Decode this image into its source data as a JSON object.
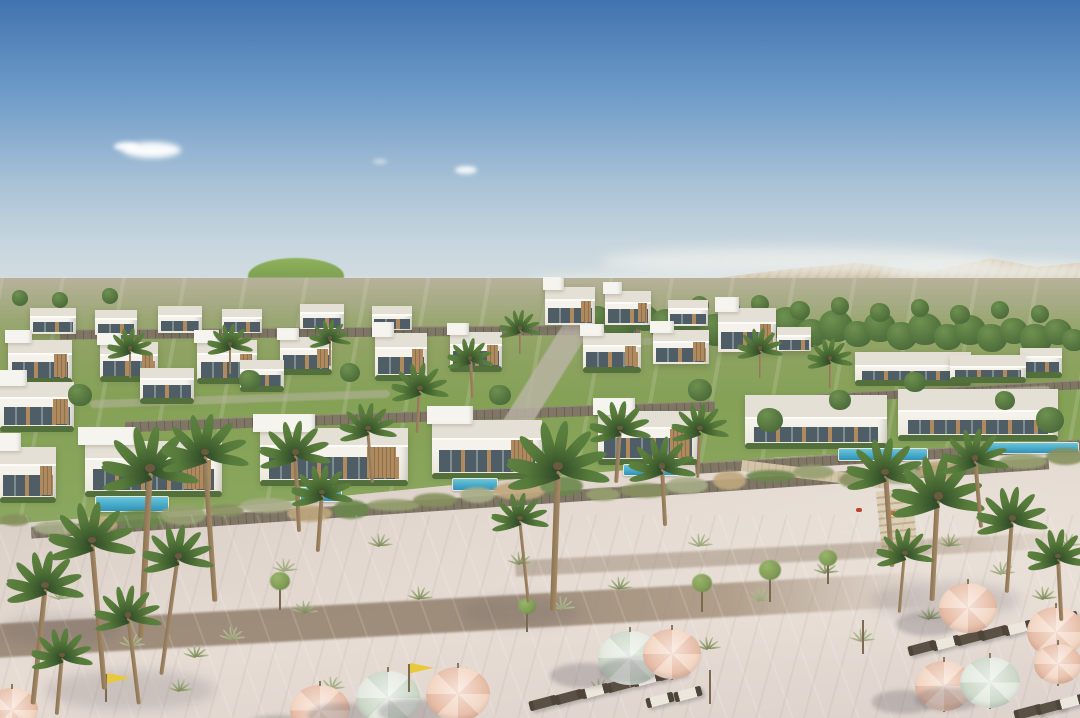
{
  "meta": {
    "subject": "Aerial rendering of a beachfront villa resort with desert mountains, terraced white villas, palm trees and a sandy beach with umbrellas",
    "caption": ""
  },
  "palette": {
    "sky_top": "#4173ae",
    "sky_mid": "#6f9cc9",
    "sky_low": "#a9c2d6",
    "sky_horizon": "#dde3e1",
    "cloud": "#ffffff",
    "mountain_light": "#dbc9aa",
    "mountain": "#c8b191",
    "mountain_dark": "#b29a78",
    "hill": "#6f9147",
    "hill_light": "#8fb25c",
    "far_lawn": "#87a355",
    "far_strip": "#dcdad0",
    "tree_dark": "#42603a",
    "tree": "#55763f",
    "tree_light": "#6e9150",
    "sapling": "#7f9b55",
    "terrace_a": "#b7b29b",
    "terrace_b": "#93a468",
    "terrace_c": "#84a156",
    "villa": "#f4f2ea",
    "villa_shade": "#e0dcd0",
    "roof": "#e4e0d5",
    "fascia": "#fcfbf8",
    "glass": "#4e5d66",
    "glass_light": "#7e8d8d",
    "wood": "#b08a5f",
    "wood_dark": "#8f6f4c",
    "stone": "#7f7666",
    "stone_dark": "#6b6253",
    "stone_light": "#958c7b",
    "hedge": "#53703c",
    "road": "#bcb5a7",
    "pool_light": "#6ac7da",
    "pool_deep": "#2e92ba",
    "pool_deck": "#ece5d6",
    "sand_dark": "#cec2b9",
    "sand": "#ded3cb",
    "sand_light": "#e6dcd4",
    "path": "#8d7a65",
    "dune_colors": [
      "#87915f",
      "#a7ad87",
      "#c0a87e",
      "#6b874c",
      "#97a171"
    ],
    "grass_olive": "#7b8a57",
    "grass_sage": "#9aa578",
    "palm_dark": "#2f4a28",
    "palm_light": "#5d8140",
    "trunk_dark": "#8a7354",
    "trunk_light": "#a68b67",
    "umbrella_peach": "#f3d6c4",
    "umbrella_peach_dark": "#e7bda7",
    "umbrella_mint": "#e4eae0",
    "umbrella_mint_dark": "#ccd8c8",
    "lounger_dark": "#4e4438",
    "lounger_mid": "#5a5144",
    "cushion": "#ece7dd",
    "flag_yellow": "#e9c93c",
    "pole": "#7d6a52",
    "shadow": "rgba(95,88,98,0.28)"
  },
  "sky": {
    "height": 318
  },
  "clouds": [
    [
      152,
      150,
      58,
      16,
      0.95,
      3
    ],
    [
      126,
      146,
      24,
      9,
      0.9,
      2
    ],
    [
      466,
      170,
      22,
      8,
      0.85,
      2
    ],
    [
      380,
      161,
      14,
      5,
      0.5,
      2
    ]
  ],
  "haze": [
    [
      800,
      262,
      400,
      28,
      0.75,
      6
    ],
    [
      1000,
      272,
      240,
      24,
      0.8,
      6
    ],
    [
      640,
      282,
      220,
      18,
      0.55,
      6
    ],
    [
      180,
      298,
      400,
      20,
      0.45,
      5
    ],
    [
      430,
      296,
      280,
      16,
      0.4,
      5
    ],
    [
      540,
      300,
      1080,
      36,
      0.42,
      5
    ]
  ],
  "mountain": {
    "left": 552,
    "top": 246,
    "width": 528,
    "height": 104,
    "clip": "polygon(0 82%,10.5% 55%,20% 41%,31% 31%,45% 22%,58% 16%,71% 25%,83% 12%,92% 20%,100% 16%,100% 100%,0 100%)"
  },
  "hill": [
    248,
    258,
    96,
    36
  ],
  "far_lawn": [
    0,
    294,
    108,
    46
  ],
  "far_strip": [
    0,
    278,
    672,
    42
  ],
  "far_boxes": [
    [
      5,
      291
    ],
    [
      25,
      286
    ],
    [
      48,
      292
    ],
    [
      70,
      288
    ],
    [
      95,
      284
    ],
    [
      118,
      291
    ],
    [
      140,
      287
    ],
    [
      165,
      293
    ],
    [
      185,
      286
    ],
    [
      210,
      290
    ],
    [
      235,
      284
    ],
    [
      258,
      292
    ],
    [
      282,
      287
    ],
    [
      305,
      283
    ],
    [
      330,
      290
    ],
    [
      352,
      285
    ],
    [
      375,
      291
    ],
    [
      398,
      286
    ],
    [
      420,
      292
    ],
    [
      445,
      287
    ],
    [
      468,
      283
    ],
    [
      490,
      290
    ],
    [
      512,
      285
    ],
    [
      535,
      291
    ],
    [
      558,
      287
    ],
    [
      580,
      292
    ],
    [
      602,
      288
    ],
    [
      625,
      284
    ],
    [
      645,
      291
    ],
    [
      688,
      295
    ],
    [
      714,
      291
    ],
    [
      738,
      296
    ]
  ],
  "terrace": {
    "left": 0,
    "top": 278,
    "width": 1080,
    "height": 268,
    "clip": "polygon(0 0,100% 0,100% 61%,72% 67%,45% 76%,20% 86%,0 92%)"
  },
  "walls": [
    [
      540,
      497,
      1020,
      11,
      -3.9
    ],
    [
      420,
      416,
      590,
      10,
      -2
    ],
    [
      890,
      456,
      390,
      10,
      -3.5
    ],
    [
      350,
      331,
      580,
      9,
      -0.5
    ],
    [
      950,
      391,
      270,
      8,
      -3
    ]
  ],
  "roads": [
    [
      545,
      378,
      26,
      140,
      32,
      0.8
    ],
    [
      240,
      399,
      300,
      8,
      -2,
      0.5
    ],
    [
      1005,
      392,
      90,
      9,
      -3,
      0.7
    ],
    [
      700,
      340,
      200,
      7,
      -1,
      0.4
    ]
  ],
  "trees_back": [
    [
      598,
      318,
      13
    ],
    [
      620,
      324,
      16
    ],
    [
      645,
      318,
      14
    ],
    [
      668,
      326,
      18
    ],
    [
      694,
      320,
      15
    ],
    [
      716,
      330,
      17
    ],
    [
      740,
      322,
      14
    ],
    [
      762,
      331,
      16
    ],
    [
      788,
      324,
      18
    ],
    [
      812,
      333,
      15
    ],
    [
      836,
      326,
      17
    ],
    [
      858,
      334,
      14
    ],
    [
      880,
      327,
      16
    ],
    [
      902,
      336,
      15
    ],
    [
      925,
      329,
      17
    ],
    [
      948,
      337,
      14
    ],
    [
      970,
      330,
      16
    ],
    [
      992,
      338,
      15
    ],
    [
      1014,
      331,
      14
    ],
    [
      1036,
      339,
      16
    ],
    [
      1058,
      332,
      14
    ],
    [
      1074,
      340,
      12
    ],
    [
      700,
      305,
      9
    ],
    [
      730,
      308,
      10
    ],
    [
      760,
      304,
      9
    ],
    [
      800,
      310,
      10
    ],
    [
      840,
      306,
      9
    ],
    [
      880,
      312,
      10
    ],
    [
      920,
      308,
      9
    ],
    [
      960,
      314,
      10
    ],
    [
      1000,
      310,
      9
    ],
    [
      1040,
      314,
      9
    ],
    [
      20,
      298,
      8
    ],
    [
      60,
      300,
      8
    ],
    [
      110,
      296,
      8
    ]
  ],
  "trees_front": [
    [
      80,
      395,
      12
    ],
    [
      250,
      380,
      11
    ],
    [
      350,
      372,
      10
    ],
    [
      500,
      395,
      11
    ],
    [
      700,
      390,
      12
    ],
    [
      770,
      420,
      13
    ],
    [
      840,
      400,
      11
    ],
    [
      1050,
      420,
      14
    ],
    [
      915,
      382,
      11
    ],
    [
      1005,
      400,
      10
    ]
  ],
  "saplings": [
    [
      280,
      588,
      10
    ],
    [
      527,
      612,
      9
    ],
    [
      702,
      590,
      10
    ],
    [
      770,
      578,
      11
    ],
    [
      828,
      564,
      9
    ]
  ],
  "villas": [
    [
      30,
      308,
      46,
      26,
      0
    ],
    [
      95,
      310,
      42,
      25,
      0
    ],
    [
      158,
      306,
      44,
      27,
      0
    ],
    [
      222,
      309,
      40,
      24,
      0
    ],
    [
      300,
      304,
      44,
      25,
      0
    ],
    [
      372,
      306,
      40,
      24,
      0
    ],
    [
      545,
      287,
      50,
      38,
      1
    ],
    [
      605,
      291,
      46,
      34,
      1
    ],
    [
      668,
      300,
      40,
      26,
      0
    ],
    [
      8,
      340,
      64,
      40,
      1
    ],
    [
      100,
      342,
      58,
      36,
      1
    ],
    [
      197,
      340,
      60,
      40,
      1
    ],
    [
      280,
      337,
      52,
      34,
      1
    ],
    [
      375,
      333,
      52,
      44,
      1
    ],
    [
      450,
      332,
      52,
      36,
      1
    ],
    [
      583,
      333,
      58,
      36,
      1
    ],
    [
      653,
      330,
      56,
      34,
      1
    ],
    [
      718,
      308,
      58,
      44,
      1
    ],
    [
      777,
      327,
      34,
      24,
      0
    ],
    [
      855,
      352,
      116,
      30,
      2
    ],
    [
      950,
      355,
      76,
      24,
      2
    ],
    [
      1020,
      348,
      42,
      26,
      0
    ],
    [
      0,
      382,
      74,
      46,
      1
    ],
    [
      140,
      368,
      54,
      32,
      0
    ],
    [
      240,
      360,
      44,
      28,
      0
    ],
    [
      0,
      447,
      56,
      52,
      1
    ],
    [
      85,
      441,
      137,
      52,
      1
    ],
    [
      260,
      428,
      148,
      54,
      1
    ],
    [
      432,
      420,
      110,
      55,
      1
    ],
    [
      598,
      411,
      100,
      50,
      1
    ],
    [
      745,
      395,
      142,
      50,
      2
    ],
    [
      898,
      389,
      160,
      48,
      2
    ]
  ],
  "pools": [
    [
      95,
      496,
      72,
      14
    ],
    [
      300,
      487,
      40,
      13
    ],
    [
      452,
      478,
      44,
      11
    ],
    [
      623,
      464,
      54,
      10
    ],
    [
      838,
      448,
      88,
      11
    ],
    [
      985,
      442,
      92,
      10
    ]
  ],
  "boardwalk": {
    "walk": [
      815,
      474,
      148,
      11,
      7
    ],
    "stairs": [
      897,
      522,
      36,
      64,
      -6
    ]
  },
  "paths": [
    [
      440,
      616,
      980,
      34,
      -3.2,
      0.8
    ],
    [
      795,
      554,
      560,
      16,
      -3,
      0.42
    ]
  ],
  "grass": [
    [
      60,
      598
    ],
    [
      88,
      545
    ],
    [
      132,
      645
    ],
    [
      196,
      656
    ],
    [
      232,
      638
    ],
    [
      305,
      612
    ],
    [
      332,
      688
    ],
    [
      420,
      598
    ],
    [
      462,
      678
    ],
    [
      520,
      563
    ],
    [
      562,
      608
    ],
    [
      620,
      588
    ],
    [
      700,
      545
    ],
    [
      708,
      648
    ],
    [
      760,
      600
    ],
    [
      826,
      572
    ],
    [
      862,
      640
    ],
    [
      950,
      545
    ],
    [
      1002,
      573
    ],
    [
      1044,
      598
    ],
    [
      1068,
      545
    ],
    [
      930,
      618
    ],
    [
      285,
      570
    ],
    [
      380,
      545
    ],
    [
      600,
      690
    ],
    [
      180,
      690
    ]
  ],
  "palms": [
    [
      45,
      585,
      1.5,
      6,
      120
    ],
    [
      92,
      540,
      1.7,
      -5,
      150
    ],
    [
      150,
      468,
      1.9,
      3,
      170
    ],
    [
      205,
      452,
      1.7,
      -4,
      150
    ],
    [
      178,
      556,
      1.4,
      8,
      120
    ],
    [
      128,
      615,
      1.3,
      -7,
      90
    ],
    [
      62,
      655,
      1.2,
      5,
      60
    ],
    [
      295,
      452,
      1.4,
      -3,
      80
    ],
    [
      322,
      492,
      1.2,
      4,
      60
    ],
    [
      368,
      428,
      1.1,
      -5,
      55
    ],
    [
      420,
      388,
      1.1,
      3,
      45
    ],
    [
      470,
      358,
      0.9,
      -3,
      40
    ],
    [
      558,
      466,
      2.0,
      2,
      145
    ],
    [
      520,
      518,
      1.1,
      -6,
      85
    ],
    [
      620,
      428,
      1.2,
      4,
      55
    ],
    [
      662,
      466,
      1.3,
      -3,
      60
    ],
    [
      700,
      428,
      1.1,
      2,
      50
    ],
    [
      885,
      472,
      1.5,
      -4,
      95
    ],
    [
      938,
      496,
      1.8,
      3,
      105
    ],
    [
      975,
      458,
      1.3,
      -5,
      70
    ],
    [
      1012,
      518,
      1.4,
      4,
      75
    ],
    [
      1058,
      556,
      1.2,
      -3,
      65
    ],
    [
      130,
      348,
      0.9,
      0,
      30
    ],
    [
      230,
      344,
      0.9,
      0,
      30
    ],
    [
      330,
      338,
      0.8,
      0,
      28
    ],
    [
      520,
      328,
      0.8,
      0,
      26
    ],
    [
      760,
      348,
      0.9,
      0,
      30
    ],
    [
      830,
      358,
      0.9,
      0,
      30
    ],
    [
      905,
      553,
      1.1,
      5,
      60
    ]
  ],
  "umbrellas": [
    [
      12,
      710,
      26,
      "peach"
    ],
    [
      320,
      710,
      30,
      "peach"
    ],
    [
      388,
      698,
      32,
      "mint"
    ],
    [
      458,
      694,
      32,
      "peach"
    ],
    [
      630,
      658,
      32,
      "mint"
    ],
    [
      672,
      654,
      29,
      "peach"
    ],
    [
      968,
      608,
      29,
      "peach"
    ],
    [
      1056,
      632,
      29,
      "peach"
    ],
    [
      944,
      686,
      29,
      "peach"
    ],
    [
      990,
      682,
      30,
      "mint"
    ],
    [
      1058,
      664,
      24,
      "peach"
    ]
  ],
  "loungers": [
    [
      543,
      703,
      "d"
    ],
    [
      569,
      697,
      "d"
    ],
    [
      595,
      691,
      "w"
    ],
    [
      621,
      685,
      "d"
    ],
    [
      647,
      679,
      "w"
    ],
    [
      672,
      673,
      "d"
    ],
    [
      660,
      700,
      "w"
    ],
    [
      688,
      694,
      "w"
    ],
    [
      922,
      648,
      "d"
    ],
    [
      946,
      643,
      "w"
    ],
    [
      970,
      638,
      "d"
    ],
    [
      994,
      633,
      "d"
    ],
    [
      1018,
      628,
      "w"
    ],
    [
      1042,
      623,
      "d"
    ],
    [
      1064,
      619,
      "d"
    ],
    [
      1028,
      712,
      "d"
    ],
    [
      1050,
      707,
      "d"
    ],
    [
      1070,
      702,
      "w"
    ]
  ],
  "flags": [
    [
      105,
      700
    ],
    [
      408,
      690
    ]
  ],
  "poles": [
    [
      709,
      700
    ],
    [
      862,
      650
    ]
  ],
  "toys": [
    [
      856,
      508,
      "#b8452e"
    ],
    [
      890,
      511,
      "#c96a2f"
    ]
  ],
  "shadow_blobs": [
    [
      130,
      690,
      170,
      40
    ],
    [
      520,
      612,
      120,
      28
    ],
    [
      945,
      600,
      150,
      36
    ],
    [
      60,
      630,
      120,
      30
    ]
  ]
}
